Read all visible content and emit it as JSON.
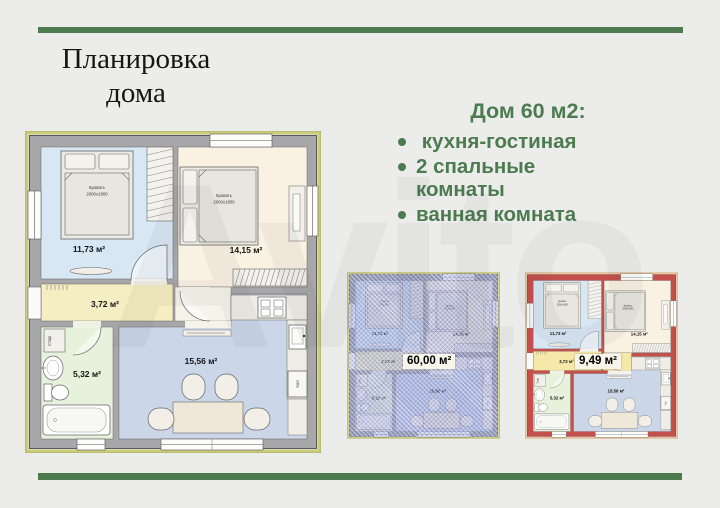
{
  "header": {
    "title_line1": "Планировка",
    "title_line2": "дома"
  },
  "summary": {
    "heading": "Дом 60 м2:",
    "bullets": [
      " кухня-гостиная",
      "2 спальные комнаты",
      "ванная комната"
    ]
  },
  "watermark": "Avito",
  "colors": {
    "accent_green": "#4c7b50",
    "divider_green": "#4d7a4e",
    "walls_highlight_red": "#c5504b",
    "total_overlay_blue": "#7c85cd",
    "background": "#ececea"
  },
  "plan": {
    "rooms": {
      "bedroom1": {
        "label": "11,73 м²"
      },
      "bedroom2": {
        "label": "14,15 м²"
      },
      "hallway": {
        "label": "3,72 м²"
      },
      "bathroom": {
        "label": "5,32 м²"
      },
      "kitchen": {
        "label": "15,56 м²"
      }
    },
    "bed_label_line1": "Кровать",
    "bed_label_line2": "2000х1800",
    "washer_label": "Стир",
    "fridge_label": "Хол"
  },
  "variants": {
    "total": {
      "label": "60,00 м²"
    },
    "walls": {
      "label": "9,49 м²"
    }
  }
}
